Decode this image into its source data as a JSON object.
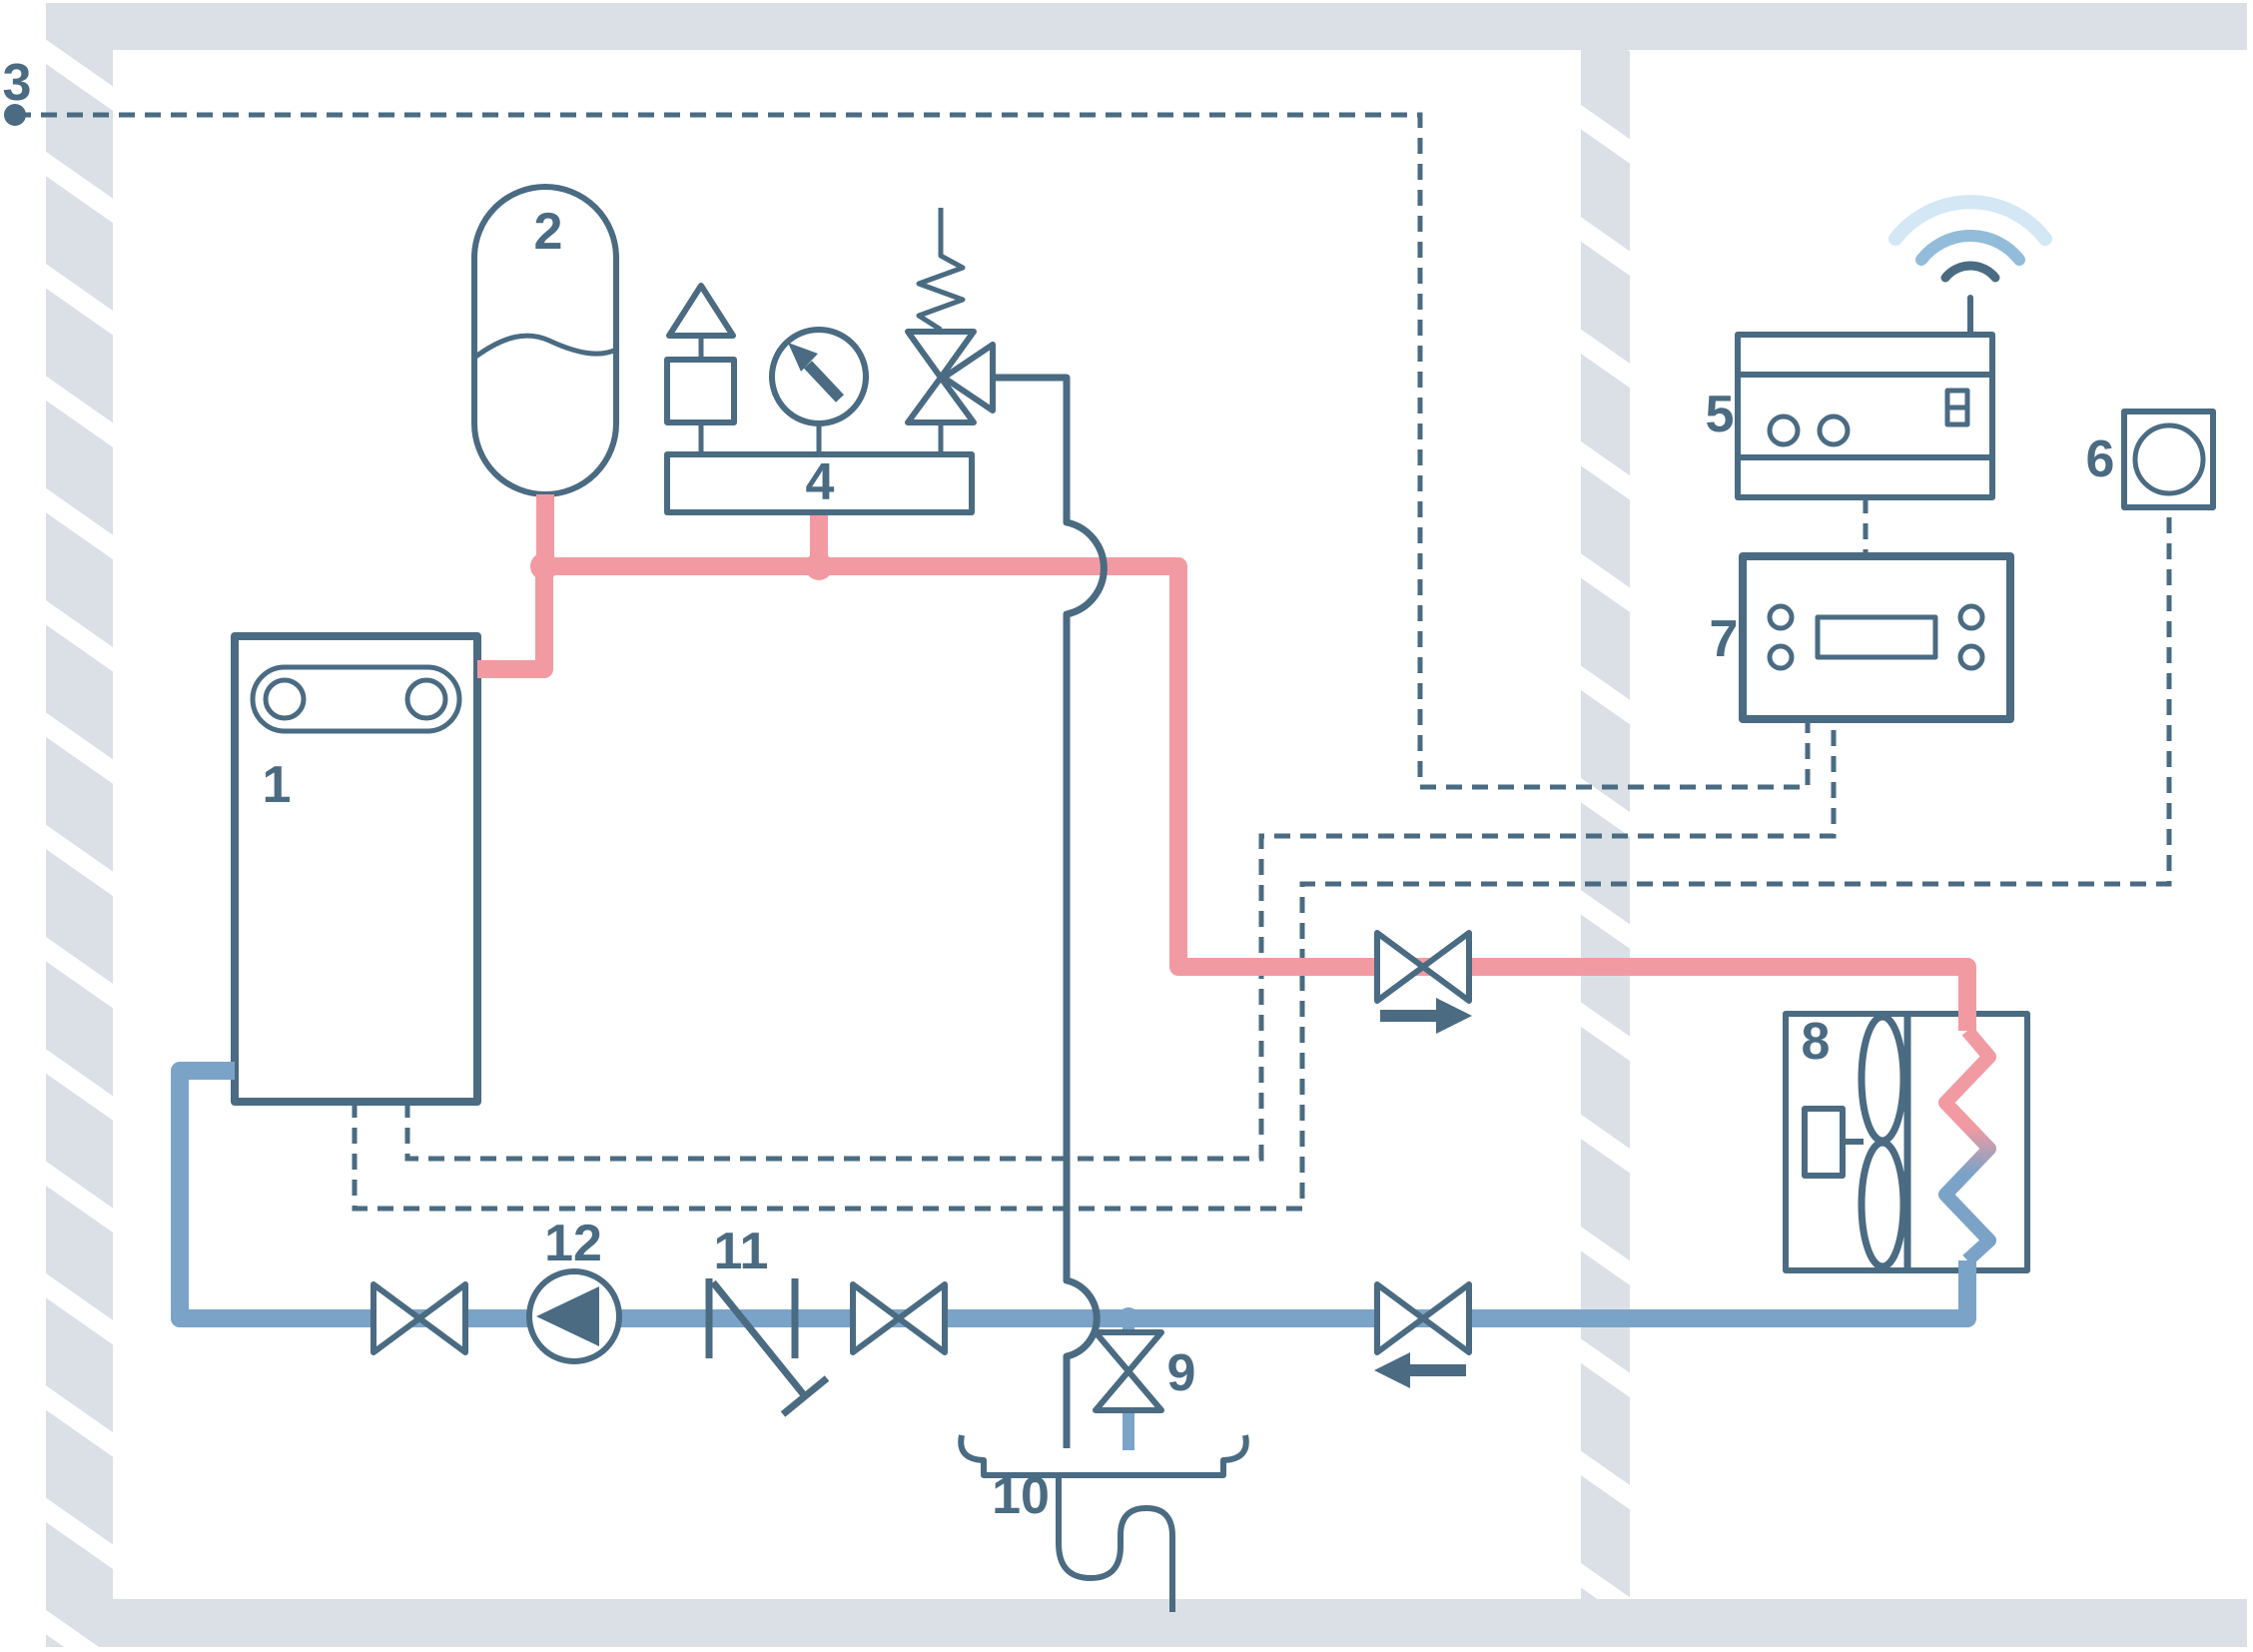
{
  "labels": {
    "l1": "1",
    "l2": "2",
    "l3": "3",
    "l4": "4",
    "l5": "5",
    "l6": "6",
    "l7": "7",
    "l8": "8",
    "l9": "9",
    "l10": "10",
    "l11": "11",
    "l12": "12"
  },
  "colors": {
    "dark": "#4a6b82",
    "pink": "#f29aa2",
    "blue": "#7ba3c8",
    "wall": "#dbe0e7",
    "wifiMid": "#92bcd9",
    "wifiLight": "#d3e7f5"
  }
}
